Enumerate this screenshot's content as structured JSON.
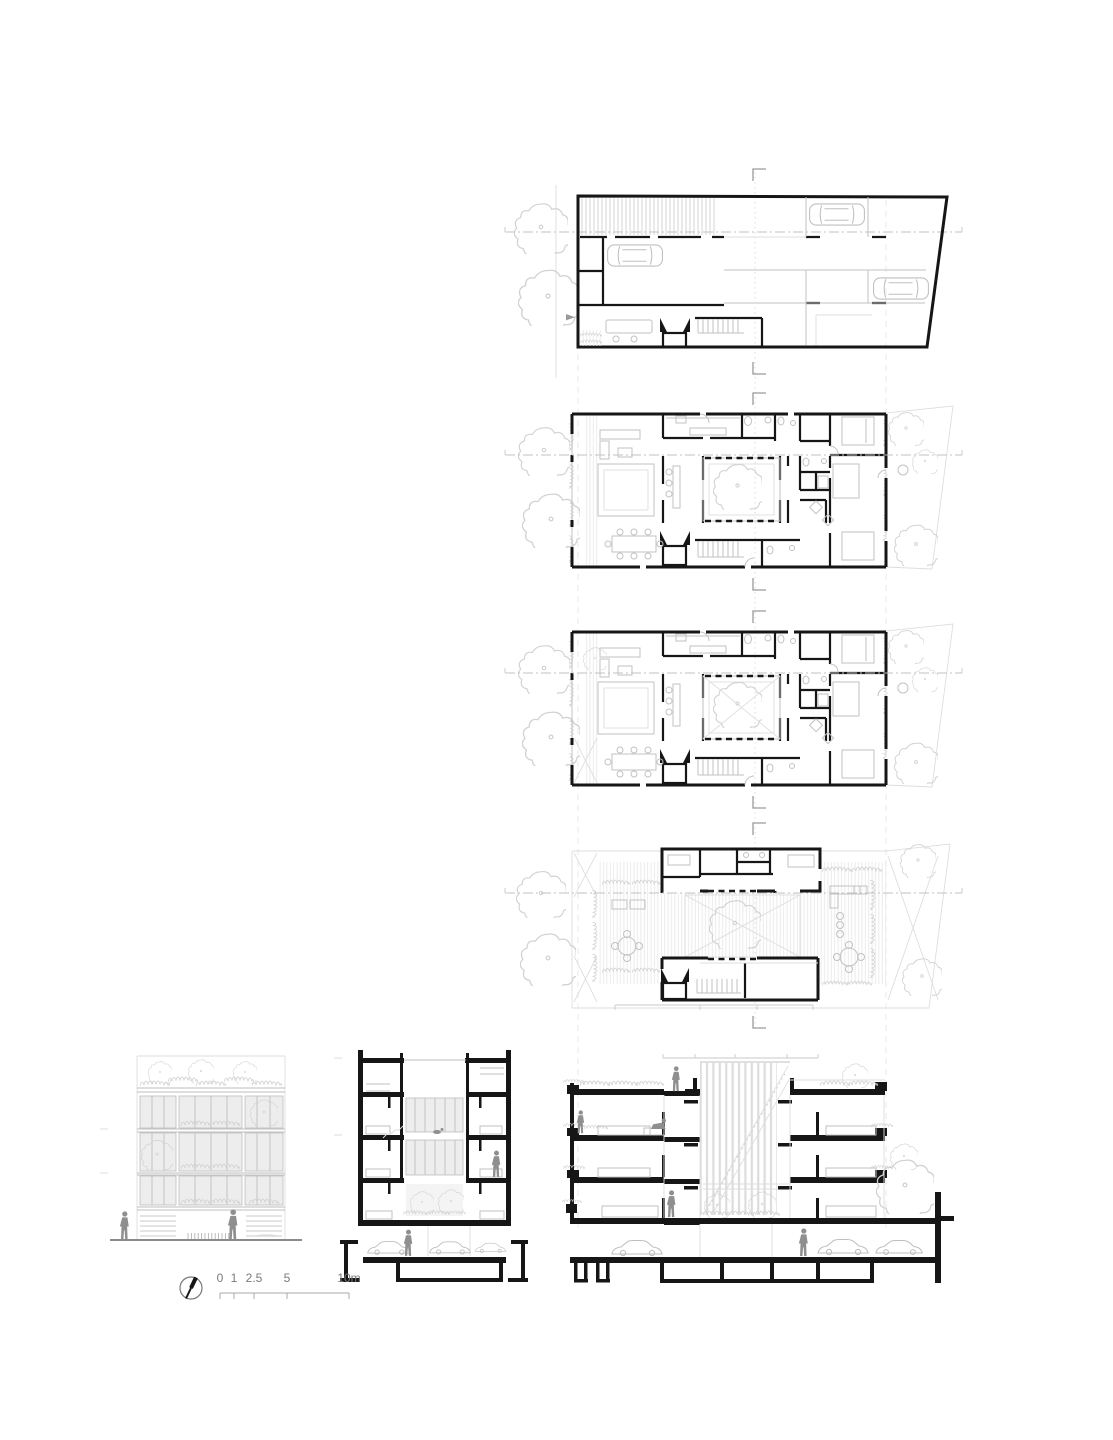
{
  "scale_bar": {
    "labels": [
      "0",
      "1",
      "2.5",
      "5",
      "10m"
    ]
  },
  "colors": {
    "paper": "#ffffff",
    "ink": "#161616",
    "bracket_gray": "#9a9a9a",
    "light_line": "#c2c2c2",
    "faint_line": "#e4e4e4",
    "vegetation_line": "#d2d2d2",
    "figure_gray": "#8f8f8f",
    "glazing_fill": "#ededed"
  },
  "drawings": {
    "panels": [
      "basement-floor-plan",
      "ground-floor-plan",
      "upper-floor-plan",
      "roof-terrace-plan",
      "street-elevation",
      "cross-section",
      "longitudinal-section"
    ],
    "symbols": [
      "north-arrow-icon",
      "scale-bar",
      "car-icon",
      "person-figure",
      "tree-icon",
      "shrub-icon"
    ]
  }
}
